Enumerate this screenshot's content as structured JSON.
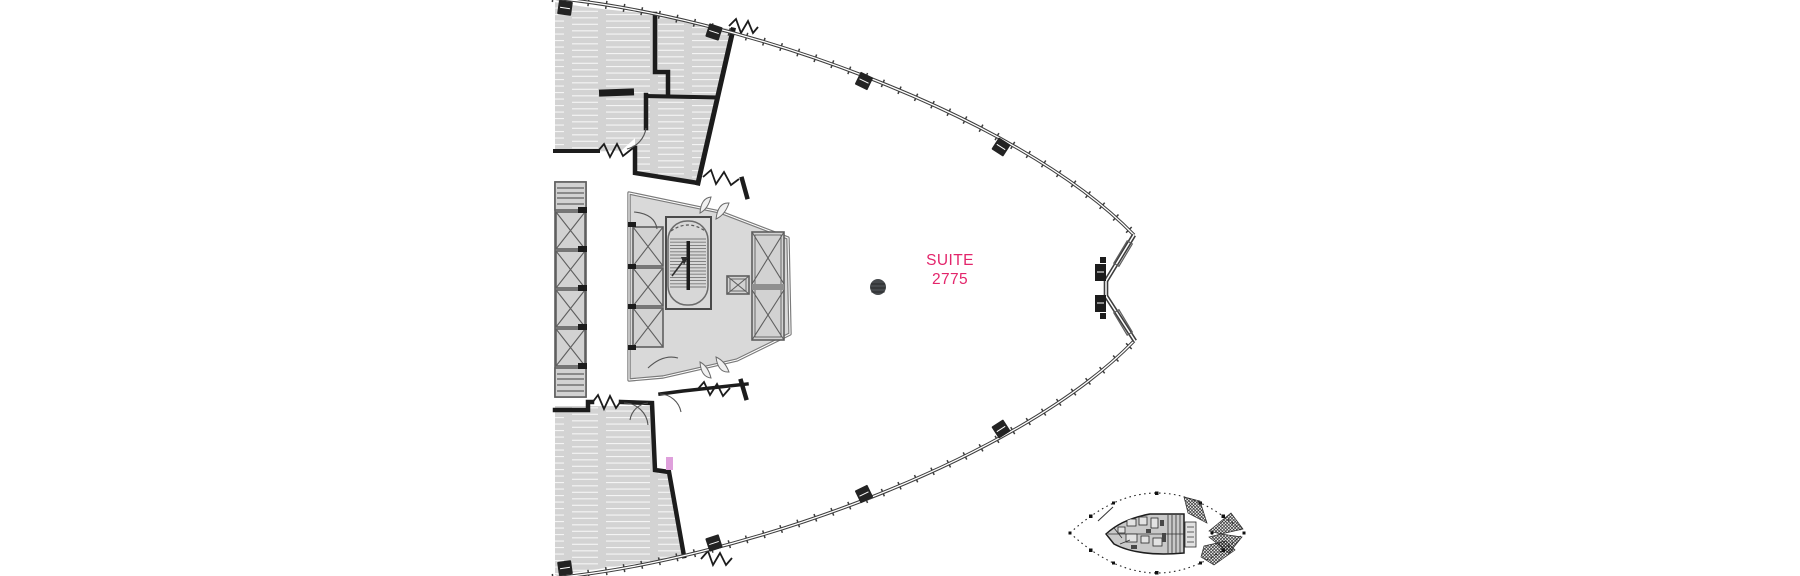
{
  "suite": {
    "line1": "SUITE",
    "line2": "2775"
  },
  "colors": {
    "accent-pink": "#E3256B",
    "entry-pink": "#DFA0DC",
    "wall": "#1c1c1c",
    "facade-line": "#3d3d3d",
    "room-fill": "#d3d3d3",
    "core-fill": "#d9d9d9",
    "core-wall": "#7a7a7a",
    "detail-line": "#5f5f5f",
    "column-dot": "#46494c",
    "canvas-bg": "#ffffff"
  },
  "icons": {
    "column_dot": "structural-column-marker",
    "key_plan": "building-key-plan-thumbnail"
  }
}
